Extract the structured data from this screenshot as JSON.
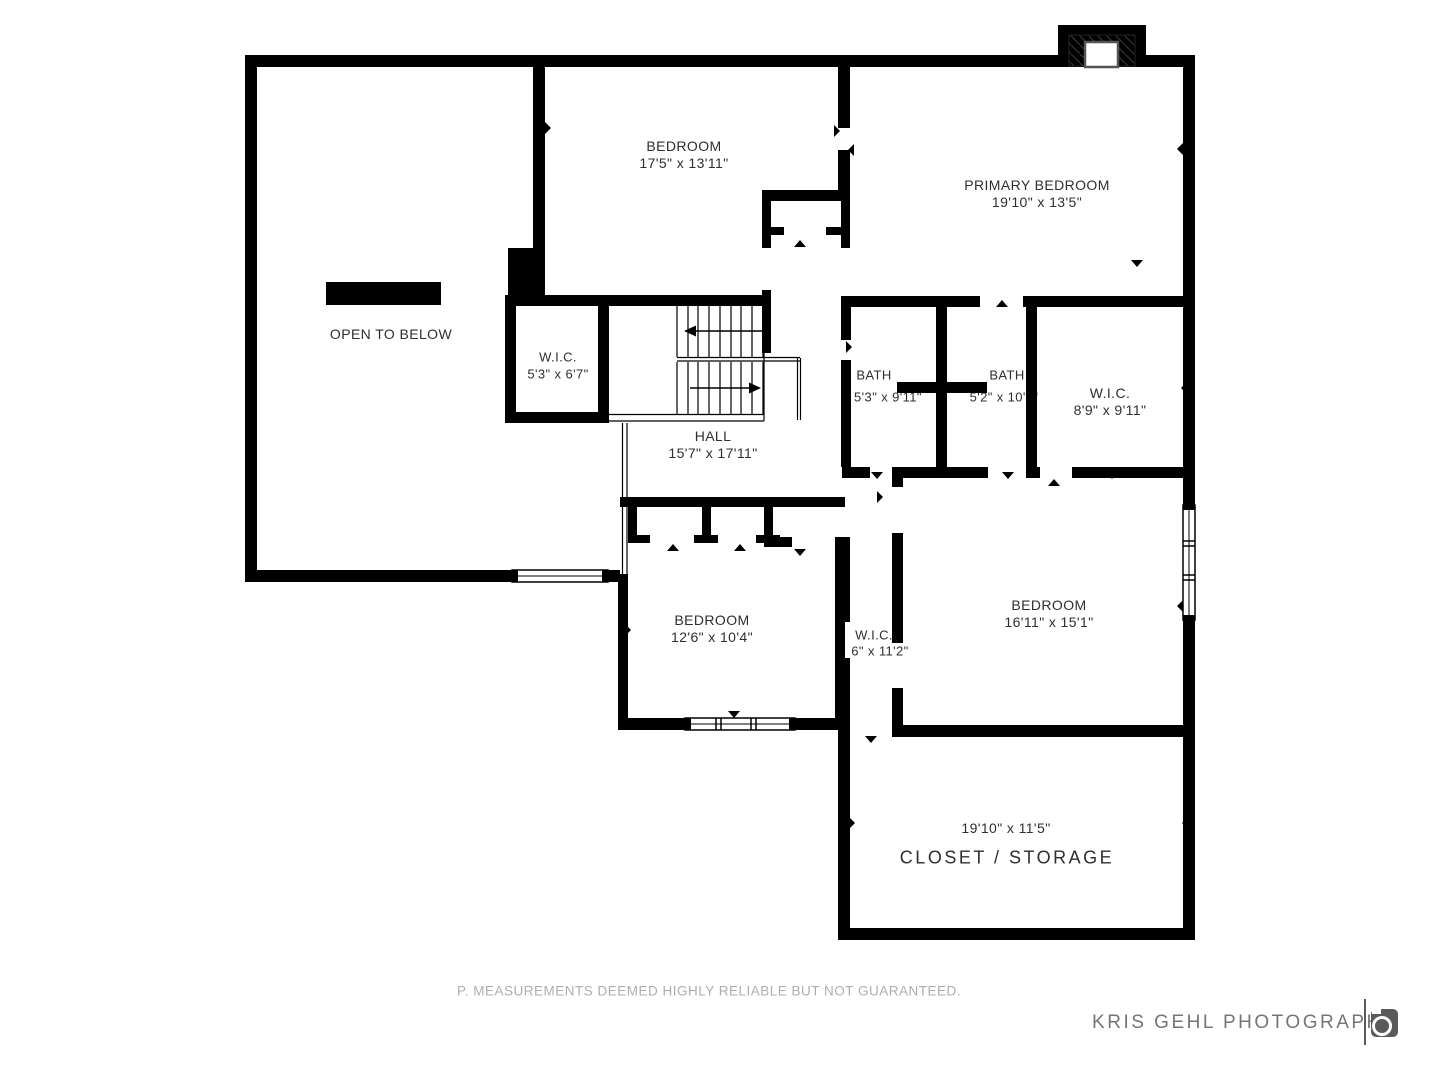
{
  "rooms": {
    "open_below": {
      "name": "OPEN TO BELOW"
    },
    "bedroom_top": {
      "name": "BEDROOM",
      "dims": "17'5\" x 13'11\""
    },
    "primary": {
      "name": "PRIMARY BEDROOM",
      "dims": "19'10\" x 13'5\""
    },
    "wic_small": {
      "name": "W.I.C.",
      "dims": "5'3\" x 6'7\""
    },
    "hall": {
      "name": "HALL",
      "dims": "15'7\" x 17'11\""
    },
    "bath_left": {
      "name": "BATH",
      "dims": "5'3\" x 9'11\""
    },
    "bath_right": {
      "name": "BATH",
      "dims": "5'2\" x 10'0\""
    },
    "wic_right": {
      "name": "W.I.C.",
      "dims": "8'9\" x 9'11\""
    },
    "bedroom_left": {
      "name": "BEDROOM",
      "dims": "12'6\" x 10'4\""
    },
    "wic_mid": {
      "name": "W.I.C.",
      "dims": "6\" x 11'2\""
    },
    "bedroom_right": {
      "name": "BEDROOM",
      "dims": "16'11\" x 15'1\""
    },
    "closet": {
      "name": "CLOSET / STORAGE",
      "dims": "19'10\" x 11'5\""
    }
  },
  "footer": {
    "disclaimer": "P. MEASUREMENTS DEEMED HIGHLY RELIABLE BUT NOT GUARANTEED."
  },
  "branding": {
    "name": "KRIS GEHL PHOTOGRAPHY",
    "icon": "camera-icon"
  },
  "colors": {
    "wall": "#000000",
    "background": "#ffffff",
    "label_text": "#2f2f2f",
    "muted_text": "#aeaeae",
    "logo_text": "#757575"
  }
}
